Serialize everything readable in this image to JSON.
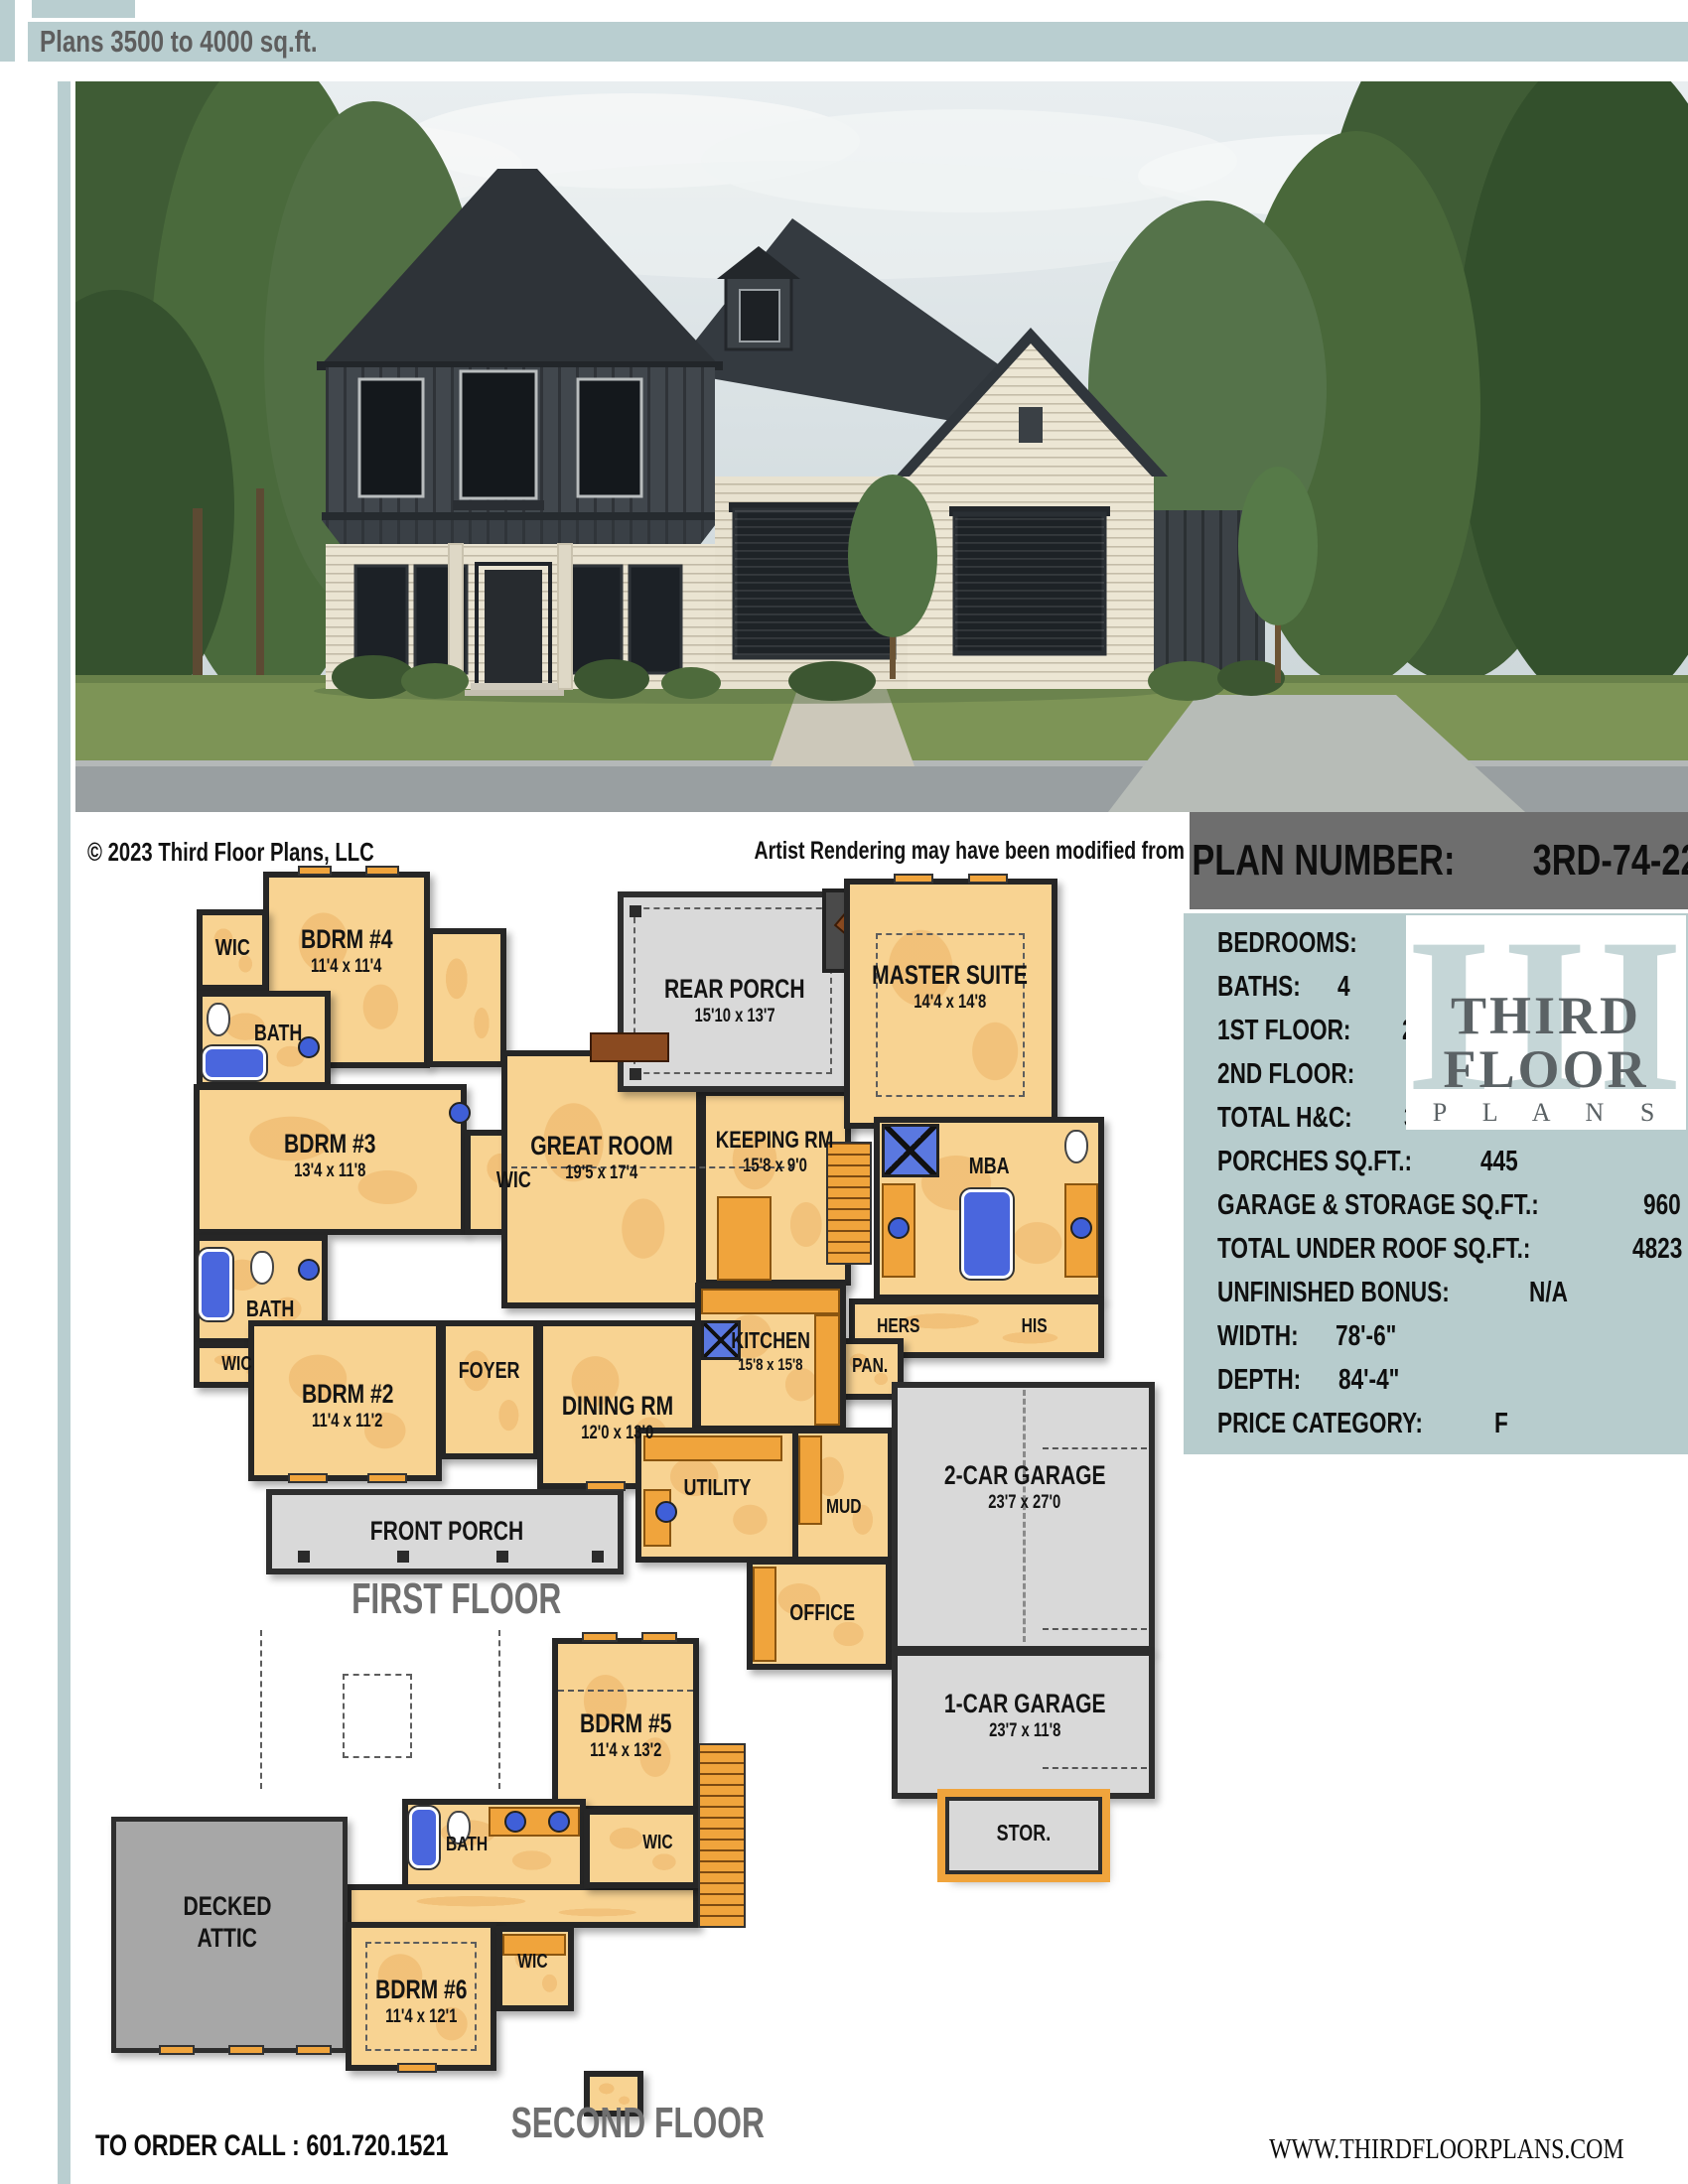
{
  "header": {
    "title": "Plans 3500 to 4000 sq.ft."
  },
  "photo": {
    "copyright": "© 2023 Third Floor Plans, LLC",
    "disclaimer": "Artist Rendering may have been modified from original plans"
  },
  "plan_info": {
    "number_label": "PLAN NUMBER:",
    "number_value": "3RD-74-22",
    "specs": [
      {
        "label": "BEDROOMS:",
        "value": "6"
      },
      {
        "label": "BATHS:",
        "value": "4"
      },
      {
        "label": "1ST FLOOR:",
        "value": "2774"
      },
      {
        "label": "2ND FLOOR:",
        "value": "644"
      },
      {
        "label": "TOTAL H&C:",
        "value": "3506"
      },
      {
        "label": "PORCHES SQ.FT.:",
        "value": "445"
      },
      {
        "label": "GARAGE & STORAGE SQ.FT.:",
        "value": "960"
      },
      {
        "label": "TOTAL UNDER ROOF SQ.FT.:",
        "value": "4823"
      },
      {
        "label": "UNFINISHED BONUS:",
        "value": "N/A"
      },
      {
        "label": "WIDTH:",
        "value": "78'-6\""
      },
      {
        "label": "DEPTH:",
        "value": "84'-4\""
      },
      {
        "label": "PRICE CATEGORY:",
        "value": "F"
      }
    ],
    "logo": {
      "numerals": "III",
      "word1": "THIRD",
      "word2": "FLOOR",
      "word3": "P L A N S"
    }
  },
  "first_floor": {
    "title": "FIRST FLOOR",
    "rooms": {
      "bdrm4": {
        "name": "BDRM #4",
        "dims": "11'4 x 11'4"
      },
      "wic4": {
        "name": "WIC"
      },
      "bath4": {
        "name": "BATH"
      },
      "bdrm3": {
        "name": "BDRM #3",
        "dims": "13'4 x 11'8"
      },
      "wic3": {
        "name": "WIC"
      },
      "bath2": {
        "name": "BATH"
      },
      "wic2": {
        "name": "WIC"
      },
      "bdrm2": {
        "name": "BDRM #2",
        "dims": "11'4 x 11'2"
      },
      "foyer": {
        "name": "FOYER"
      },
      "dining": {
        "name": "DINING RM",
        "dims": "12'0 x 13'0"
      },
      "great": {
        "name": "GREAT ROOM",
        "dims": "19'5 x 17'4"
      },
      "keeping": {
        "name": "KEEPING RM",
        "dims": "15'8 x 9'0"
      },
      "rear_porch": {
        "name": "REAR PORCH",
        "dims": "15'10 x 13'7"
      },
      "master": {
        "name": "MASTER SUITE",
        "dims": "14'4 x 14'8"
      },
      "mba": {
        "name": "MBA"
      },
      "hers": {
        "name": "HERS"
      },
      "his": {
        "name": "HIS"
      },
      "pan": {
        "name": "PAN."
      },
      "kitchen": {
        "name": "KITCHEN",
        "dims": "15'8 x 15'8"
      },
      "mud": {
        "name": "MUD"
      },
      "utility": {
        "name": "UTILITY"
      },
      "office": {
        "name": "OFFICE"
      },
      "garage2": {
        "name": "2-CAR GARAGE",
        "dims": "23'7 x 27'0"
      },
      "garage1": {
        "name": "1-CAR GARAGE",
        "dims": "23'7 x 11'8"
      },
      "stor": {
        "name": "STOR."
      },
      "front_porch": {
        "name": "FRONT PORCH"
      }
    }
  },
  "second_floor": {
    "title": "SECOND FLOOR",
    "rooms": {
      "bdrm5": {
        "name": "BDRM #5",
        "dims": "11'4 x 13'2"
      },
      "bath5": {
        "name": "BATH"
      },
      "wic5": {
        "name": "WIC"
      },
      "decked_attic": {
        "line1": "DECKED",
        "line2": "ATTIC"
      },
      "bdrm6": {
        "name": "BDRM #6",
        "dims": "11'4 x 12'1"
      },
      "wic6": {
        "name": "WIC"
      }
    }
  },
  "footer": {
    "order_call": "TO ORDER CALL :  601.720.1521",
    "website": "WWW.THIRDFLOORPLANS.COM"
  },
  "colors": {
    "accent": "#b9ced0",
    "plan_bar": "#6e6e6e",
    "room_fill": "#f8d392",
    "porch_fill": "#d9d9d9",
    "attic_fill": "#a7a7a7",
    "cabinet": "#f0a43c",
    "fixture": "#4a66dd"
  }
}
